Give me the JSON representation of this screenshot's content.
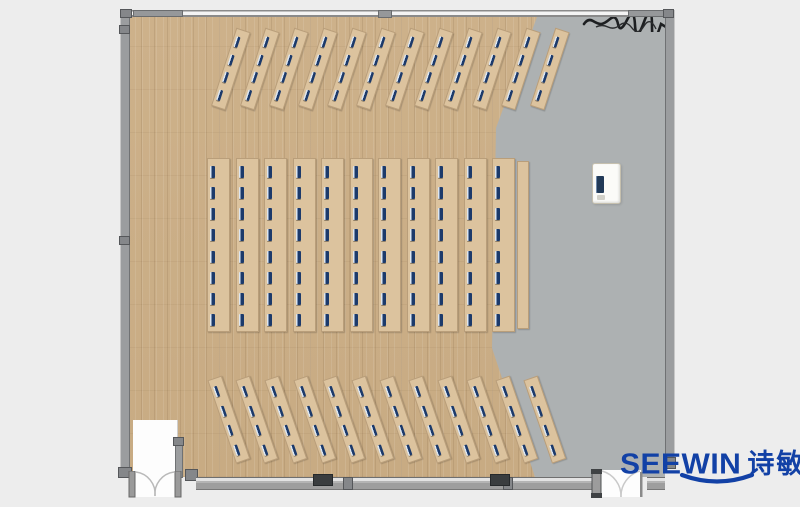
{
  "brand": {
    "name": "SEEWIN",
    "cjk": "诗敏",
    "color": "#1241a6"
  },
  "palette": {
    "background": "#ededed",
    "wood_floor": "#c9ad86",
    "gray_floor": "#adb1b2",
    "wall_gray": "#9b9d9f",
    "column_dark": "#3a3d3f",
    "desk_wood": "#dcc39e",
    "monitor_navy": "#1c3a6b",
    "door_white": "#fdfdfd"
  },
  "plan": {
    "room": {
      "x": 120,
      "y": 9,
      "w": 554,
      "h": 481
    },
    "groups": [
      {
        "id": "top-rows",
        "type": "diagonal",
        "count": 12,
        "x0": 243,
        "step": 29,
        "y": 30,
        "len": 82,
        "w": 15,
        "angle": 18,
        "seats": 4
      },
      {
        "id": "middle-columns",
        "type": "straight",
        "count": 11,
        "x0": 218.5,
        "step": 28.5,
        "y": 158,
        "len": 174,
        "w": 23,
        "angle": 0,
        "seats": 8
      },
      {
        "id": "bottom-rows",
        "type": "diagonal",
        "count": 12,
        "x0": 214,
        "step": 28.8,
        "y": 378,
        "len": 88,
        "w": 15,
        "angle": -19,
        "seats": 4
      }
    ],
    "side_strip": {
      "x": 517,
      "y": 161,
      "w": 12,
      "h": 168
    },
    "podium": {
      "x": 592,
      "y": 163,
      "w": 27,
      "h": 39
    }
  }
}
